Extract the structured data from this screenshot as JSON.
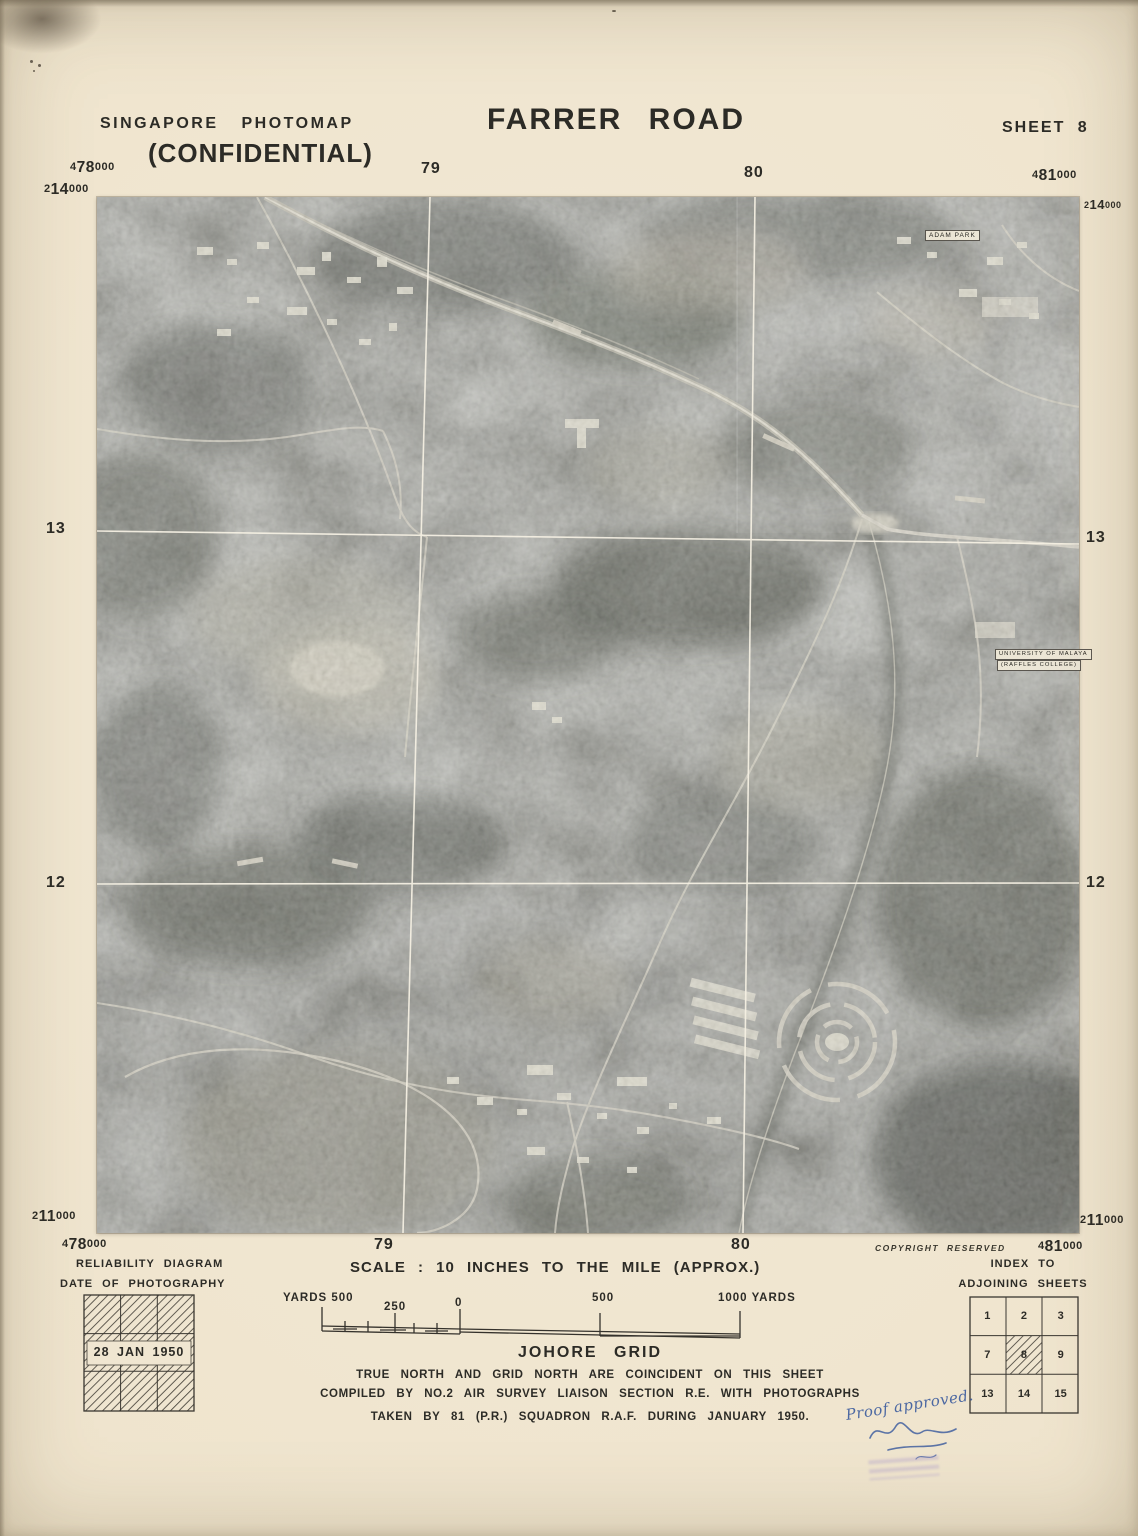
{
  "header": {
    "series": "SINGAPORE PHOTOMAP",
    "confidential": "(CONFIDENTIAL)",
    "title": "FARRER ROAD",
    "sheet": "SHEET 8"
  },
  "grid": {
    "easting_478": {
      "pre": "4",
      "big": "78",
      "post": "000"
    },
    "easting_481": {
      "pre": "4",
      "big": "81",
      "post": "000"
    },
    "easting_79": "79",
    "easting_80": "80",
    "northing_214": {
      "pre": "2",
      "big": "14",
      "post": "000"
    },
    "northing_211": {
      "pre": "2",
      "big": "11",
      "post": "000"
    },
    "northing_13": "13",
    "northing_12": "12"
  },
  "map": {
    "labels": {
      "adam_park": "ADAM PARK",
      "university_line1": "UNIVERSITY OF MALAYA",
      "university_line2": "(RAFFLES COLLEGE)"
    }
  },
  "legend": {
    "reliability_title1": "RELIABILITY DIAGRAM",
    "reliability_title2": "DATE OF PHOTOGRAPHY",
    "reliability_date": "28 JAN 1950",
    "scale_text": "SCALE : 10 INCHES TO THE MILE (APPROX.)",
    "scale_yards_left": "YARDS 500",
    "scale_250": "250",
    "scale_0": "0",
    "scale_500": "500",
    "scale_1000": "1000 YARDS",
    "grid_name": "JOHORE GRID",
    "note1": "TRUE NORTH AND GRID NORTH ARE COINCIDENT ON THIS SHEET",
    "note2": "COMPILED BY NO.2 AIR SURVEY LIAISON SECTION R.E. WITH PHOTOGRAPHS",
    "note3": "TAKEN BY 81 (P.R.) SQUADRON R.A.F. DURING JANUARY 1950.",
    "copyright": "COPYRIGHT RESERVED",
    "index_title1": "INDEX TO",
    "index_title2": "ADJOINING SHEETS",
    "index_sheets": [
      "1",
      "2",
      "3",
      "7",
      "8",
      "9",
      "13",
      "14",
      "15"
    ],
    "current_sheet": "8"
  },
  "annotations": {
    "proof_note": "Proof approved."
  },
  "colors": {
    "paper": "#f0e6d1",
    "ink": "#2c2b26",
    "photo_gray": "#90928a",
    "handwriting_blue": "#4c68a2"
  }
}
